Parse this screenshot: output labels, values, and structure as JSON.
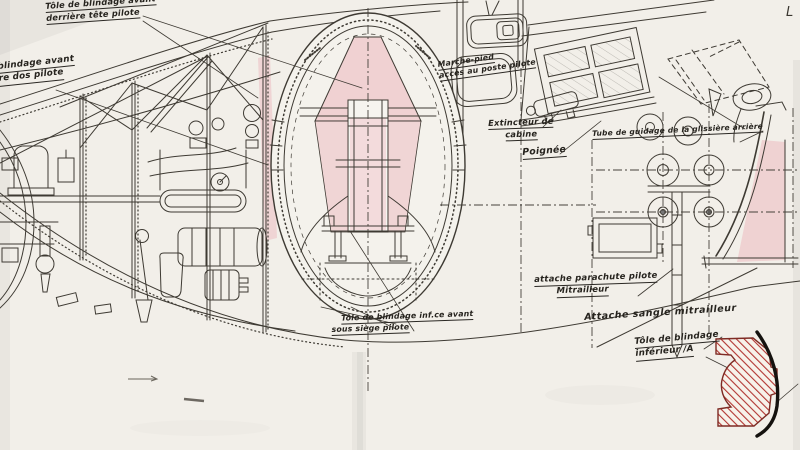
{
  "labels": {
    "armor_head": {
      "l1": "Tôle de blindage avant",
      "l2": "derrière tête pilote"
    },
    "armor_back": {
      "l1": "blindage avant",
      "l2": "re dos pilote"
    },
    "footstep": {
      "l1": "Marche-pied",
      "l2": "accès au poste pilote"
    },
    "extinguisher": {
      "l1": "Extincteur de",
      "l2": "cabine"
    },
    "handle": {
      "l1": "Poignée"
    },
    "guide_tube": {
      "l1": "Tube de guidage de la glissière arrière"
    },
    "parachute": {
      "l1": "attache parachute pilote",
      "l2": "Mitrailleur"
    },
    "strap": {
      "l1": "Attache sangle mitrailleur"
    },
    "armor_seat": {
      "l1": "Tôle de blindage inf.ce avant",
      "l2": "sous siège pilote"
    },
    "armor_lower": {
      "l1": "Tôle de blindage",
      "l2": "inférieur /A"
    },
    "corner_mark": "L"
  },
  "colors": {
    "paper": "#f2efe9",
    "ink": "#3e3a33",
    "armor_highlight": "#eba9b3",
    "armor_hatch_red": "#b23531",
    "section_arc_black": "#15120f"
  }
}
